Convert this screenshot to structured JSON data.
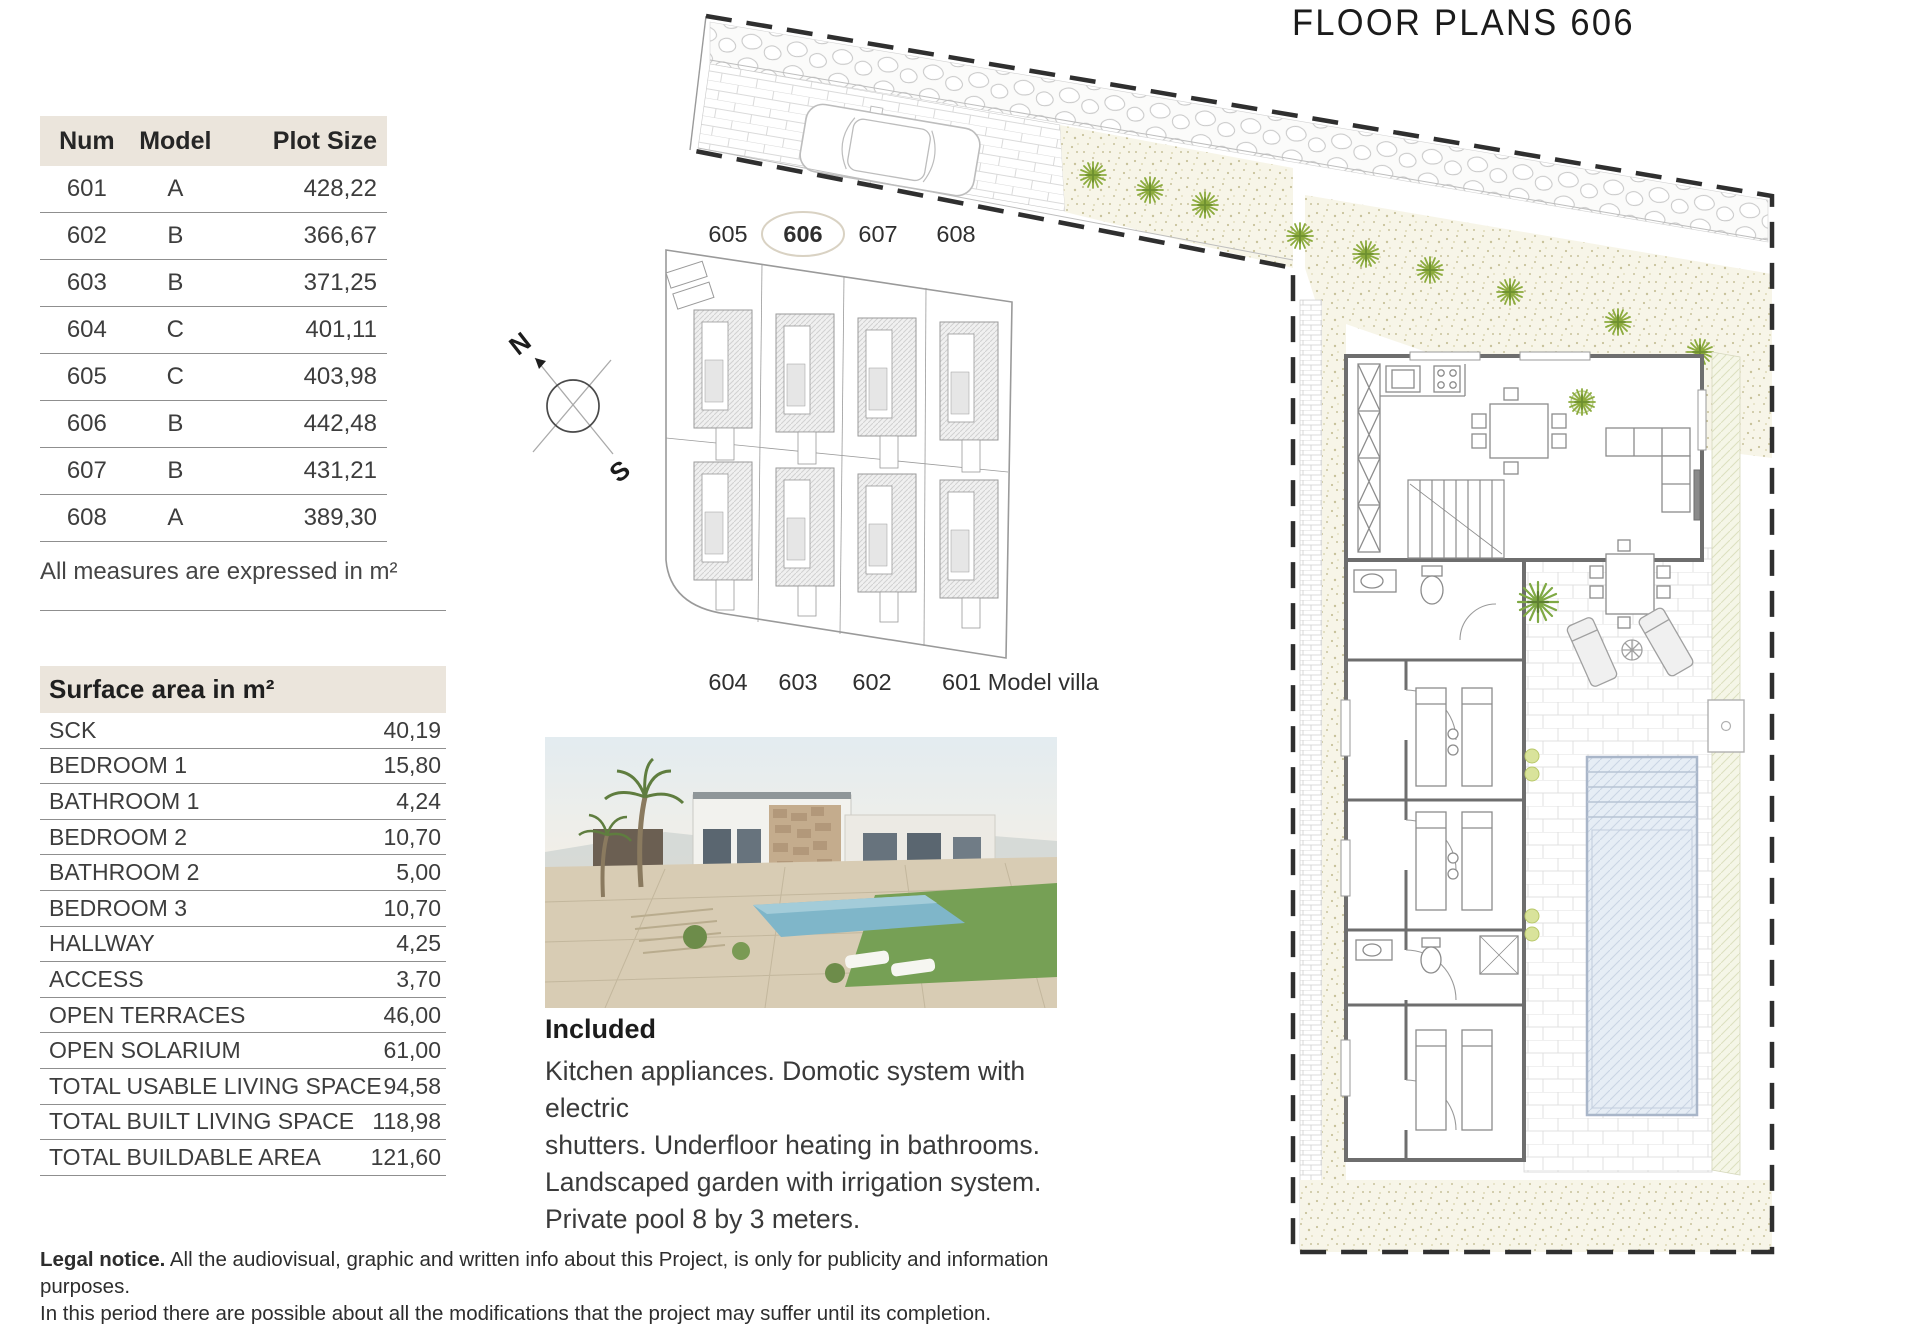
{
  "title": "FLOOR PLANS 606",
  "plot_table": {
    "headers": [
      "Num",
      "Model",
      "Plot Size"
    ],
    "rows": [
      [
        "601",
        "A",
        "428,22"
      ],
      [
        "602",
        "B",
        "366,67"
      ],
      [
        "603",
        "B",
        "371,25"
      ],
      [
        "604",
        "C",
        "401,11"
      ],
      [
        "605",
        "C",
        "403,98"
      ],
      [
        "606",
        "B",
        "442,48"
      ],
      [
        "607",
        "B",
        "431,21"
      ],
      [
        "608",
        "A",
        "389,30"
      ]
    ],
    "note": "All measures are expressed in m²"
  },
  "surface_table": {
    "header": "Surface area in m²",
    "rows": [
      [
        "SCK",
        "40,19"
      ],
      [
        "BEDROOM 1",
        "15,80"
      ],
      [
        "BATHROOM 1",
        "4,24"
      ],
      [
        "BEDROOM 2",
        "10,70"
      ],
      [
        "BATHROOM 2",
        "5,00"
      ],
      [
        "BEDROOM 3",
        "10,70"
      ],
      [
        "HALLWAY",
        "4,25"
      ],
      [
        "ACCESS",
        "3,70"
      ],
      [
        "OPEN TERRACES",
        "46,00"
      ],
      [
        "OPEN SOLARIUM",
        "61,00"
      ],
      [
        "TOTAL USABLE LIVING SPACE",
        "94,58"
      ],
      [
        "TOTAL BUILT LIVING SPACE",
        "118,98"
      ],
      [
        "TOTAL BUILDABLE AREA",
        "121,60"
      ]
    ]
  },
  "site_plan": {
    "top_labels": [
      "605",
      "606",
      "607",
      "608"
    ],
    "highlighted_plot": "606",
    "bottom_labels": [
      "604",
      "603",
      "602",
      "601 Model villa"
    ]
  },
  "compass": {
    "north": "N",
    "south": "S"
  },
  "included": {
    "heading": "Included",
    "lines": [
      "Kitchen appliances. Domotic system with electric",
      "shutters. Underfloor heating in bathrooms.",
      "Landscaped garden with irrigation system.",
      "Private pool 8 by 3 meters."
    ]
  },
  "legal": {
    "bold": "Legal notice.",
    "text": " All the audiovisual, graphic and written info about this Project, is only for publicity and information purposes.",
    "line2": "In this period there are possible about all the modifications that the project may suffer until its completion."
  },
  "colors": {
    "header_beige": "#ebe5dc",
    "line_gray": "#8f8f8f",
    "plant_green": "#8cab3d",
    "gravel_bg": "#f7f5e8",
    "pool_fill": "#e6edf5",
    "pool_border": "#a9b6c9",
    "hatch_band": "#f5f6e7",
    "text_dark": "#2f2f2f"
  }
}
